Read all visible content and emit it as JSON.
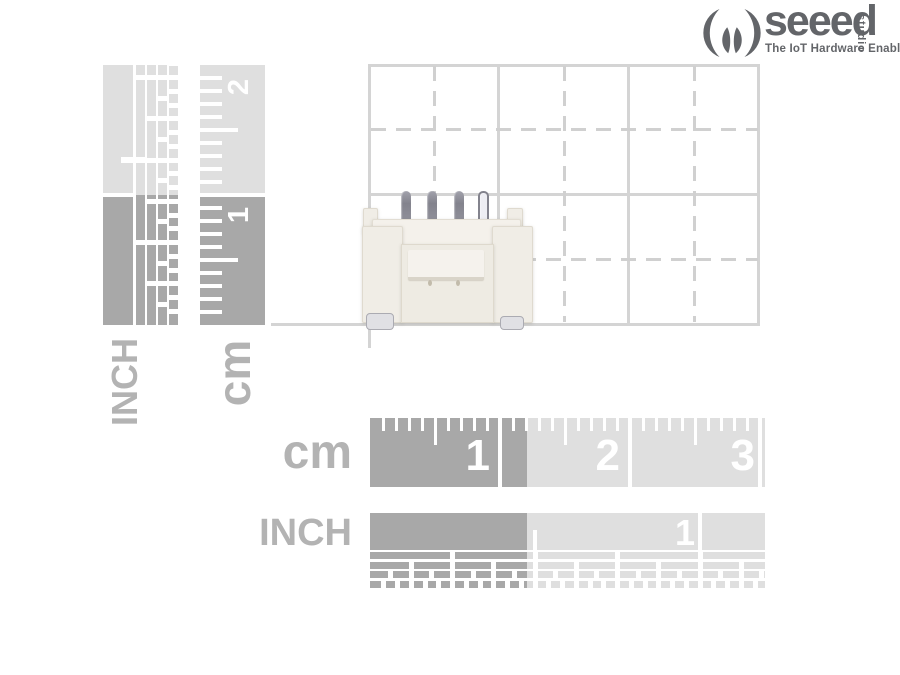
{
  "logo": {
    "brand": "seeed",
    "studio": "studio",
    "tagline": "The IoT Hardware Enabler"
  },
  "rulers": {
    "left_inch": {
      "label": "INCH"
    },
    "left_cm": {
      "label": "cm",
      "numbers": [
        "2",
        "1"
      ]
    },
    "bottom_cm": {
      "label": "cm",
      "numbers": [
        "1",
        "2",
        "3"
      ]
    },
    "bottom_inch": {
      "label": "INCH",
      "numbers": [
        "1"
      ]
    }
  },
  "colors": {
    "ruler_dark": "#a8a8a8",
    "ruler_light": "#dfdfdf",
    "tick_white": "#ffffff",
    "grid_solid": "#d4d4d4",
    "grid_dashed": "#d0d0d0",
    "label_gray": "#b3b3b3",
    "logo_gray": "#636569"
  }
}
